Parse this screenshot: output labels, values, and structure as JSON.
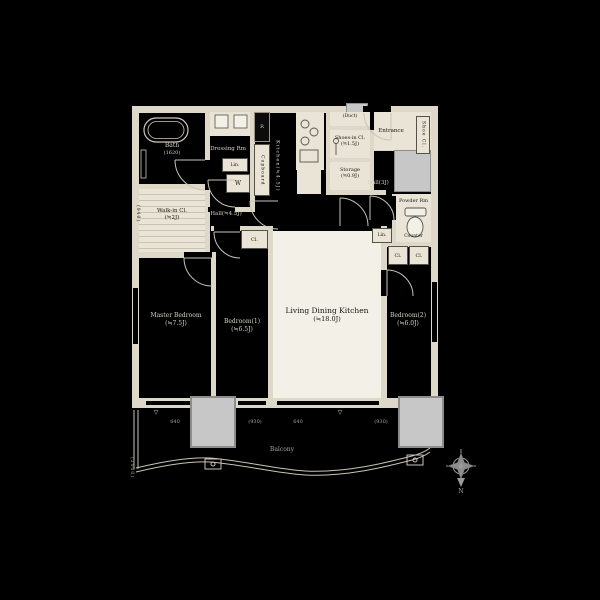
{
  "floorplan": {
    "rooms": {
      "bath": {
        "name": "Bath",
        "size": "(1620)"
      },
      "dressing_rm": {
        "name": "Dressing Rm"
      },
      "walk_in_cl": {
        "name": "Walk-in Cl.",
        "size": "(≒2J)"
      },
      "kitchen": {
        "label": "Kitchen(≒4.5J)"
      },
      "shoes_in_cl": {
        "name": "Shoes-in Cl.",
        "size": "(≒1.5J)"
      },
      "storage": {
        "name": "Storage",
        "size": "(≒0.9J)"
      },
      "entrance": {
        "name": "Entrance"
      },
      "hall_entry": {
        "label": "Hall(3J)"
      },
      "hall_inner": {
        "label": "Hall(≒4.5J)"
      },
      "powder_rm": {
        "name": "Powder Rm"
      },
      "master_bedroom": {
        "name": "Master Bedroom",
        "size": "(≒7.5J)"
      },
      "bedroom1": {
        "name": "Bedroom(1)",
        "size": "(≒6.5J)"
      },
      "bedroom2": {
        "name": "Bedroom(2)",
        "size": "(≒6.0J)"
      },
      "ldk": {
        "name": "Living Dining Kitchen",
        "size": "(≒18.0J)"
      },
      "balcony": {
        "name": "Balcony"
      }
    },
    "fixtures": {
      "cupboard": "Cupboard",
      "refrigerator": "R",
      "washer": "W",
      "linen1": "Lin.",
      "linen2": "Lin.",
      "duct": "(Duct)",
      "shoe_cl": "Shoe Cl.",
      "counter": "Counter",
      "closet1": "Cl.",
      "closet2": "Cl.",
      "closet3": "Cl."
    },
    "dimensions": {
      "bottom": [
        "640",
        "(930)",
        "640",
        "(930)"
      ],
      "left_wall": "(940)",
      "balcony_side": "(2000)"
    },
    "markers": {
      "level1": "▽",
      "level2": "▽"
    },
    "compass": {
      "north": "N"
    }
  }
}
